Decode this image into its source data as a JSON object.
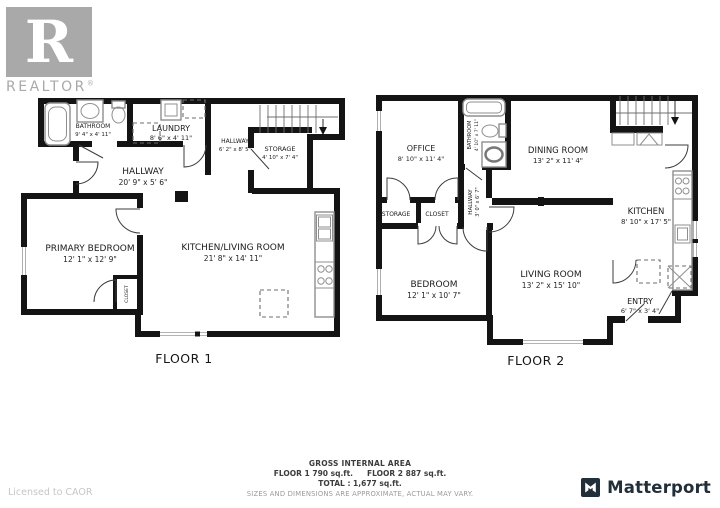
{
  "branding": {
    "realtor_letter": "R",
    "realtor_word": "REALTOR",
    "realtor_reg": "®",
    "license_text": "Licensed to CAOR",
    "matterport_text": "Matterport"
  },
  "floor1": {
    "label": "FLOOR 1",
    "rooms": {
      "bathroom": {
        "name": "BATHROOM",
        "dims": "9' 4\" x 4' 11\""
      },
      "laundry": {
        "name": "LAUNDRY",
        "dims": "8' 6\" x 4' 11\""
      },
      "hallway_small": {
        "name": "HALLWAY",
        "dims": "6' 2\" x 8' 5\""
      },
      "storage": {
        "name": "STORAGE",
        "dims": "4' 10\" x 7' 4\""
      },
      "hallway": {
        "name": "HALLWAY",
        "dims": "20' 9\" x 5' 6\""
      },
      "primary_bedroom": {
        "name": "PRIMARY BEDROOM",
        "dims": "12' 1\" x 12' 9\""
      },
      "kitchen_living": {
        "name": "KITCHEN/LIVING ROOM",
        "dims": "21' 8\" x 14' 11\""
      },
      "closet": {
        "name": "CLOSET"
      }
    }
  },
  "floor2": {
    "label": "FLOOR 2",
    "rooms": {
      "office": {
        "name": "OFFICE",
        "dims": "8' 10\" x 11' 4\""
      },
      "bathroom": {
        "name": "BATHROOM",
        "dims": "4' 10\" x 7' 11\""
      },
      "dining": {
        "name": "DINING ROOM",
        "dims": "13' 2\" x 11' 4\""
      },
      "kitchen": {
        "name": "KITCHEN",
        "dims": "8' 10\" x 17' 5\""
      },
      "hallway": {
        "name": "HALLWAY",
        "dims": "3' 0\" x 6' 7\""
      },
      "storage": {
        "name": "STORAGE"
      },
      "closet": {
        "name": "CLOSET"
      },
      "bedroom": {
        "name": "BEDROOM",
        "dims": "12' 1\" x 10' 7\""
      },
      "living": {
        "name": "LIVING ROOM",
        "dims": "13' 2\" x 15' 10\""
      },
      "entry": {
        "name": "ENTRY",
        "dims": "6' 7\" x 3' 4\""
      }
    }
  },
  "footer": {
    "gross_title": "GROSS INTERNAL AREA",
    "floor1_area": "FLOOR 1 790 sq.ft.",
    "floor2_area": "FLOOR 2 887 sq.ft.",
    "total": "TOTAL :  1,677 sq.ft.",
    "disclaimer": "SIZES AND DIMENSIONS ARE APPROXIMATE, ACTUAL MAY VARY."
  },
  "colors": {
    "wall": "#141414",
    "fixture": "#8f8f8f",
    "matterport_dark": "#222e38",
    "realtor_gray": "#a9a9a9"
  }
}
